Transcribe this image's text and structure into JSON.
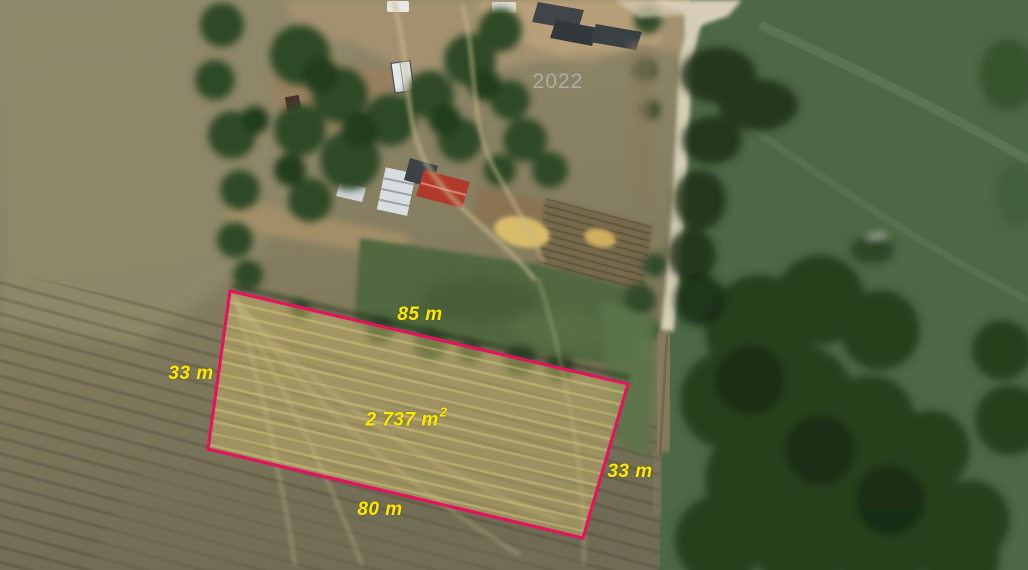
{
  "map": {
    "watermark": "2022"
  },
  "parcel": {
    "outline_color": "#e5135e",
    "label_color": "#ffe800",
    "points": "230,291 628,384 583,538 208,449",
    "measurements": {
      "top": "85 m",
      "left": "33 m",
      "right": "33 m",
      "bottom": "80 m",
      "area": "2 737 m",
      "area_exponent": "2"
    }
  }
}
